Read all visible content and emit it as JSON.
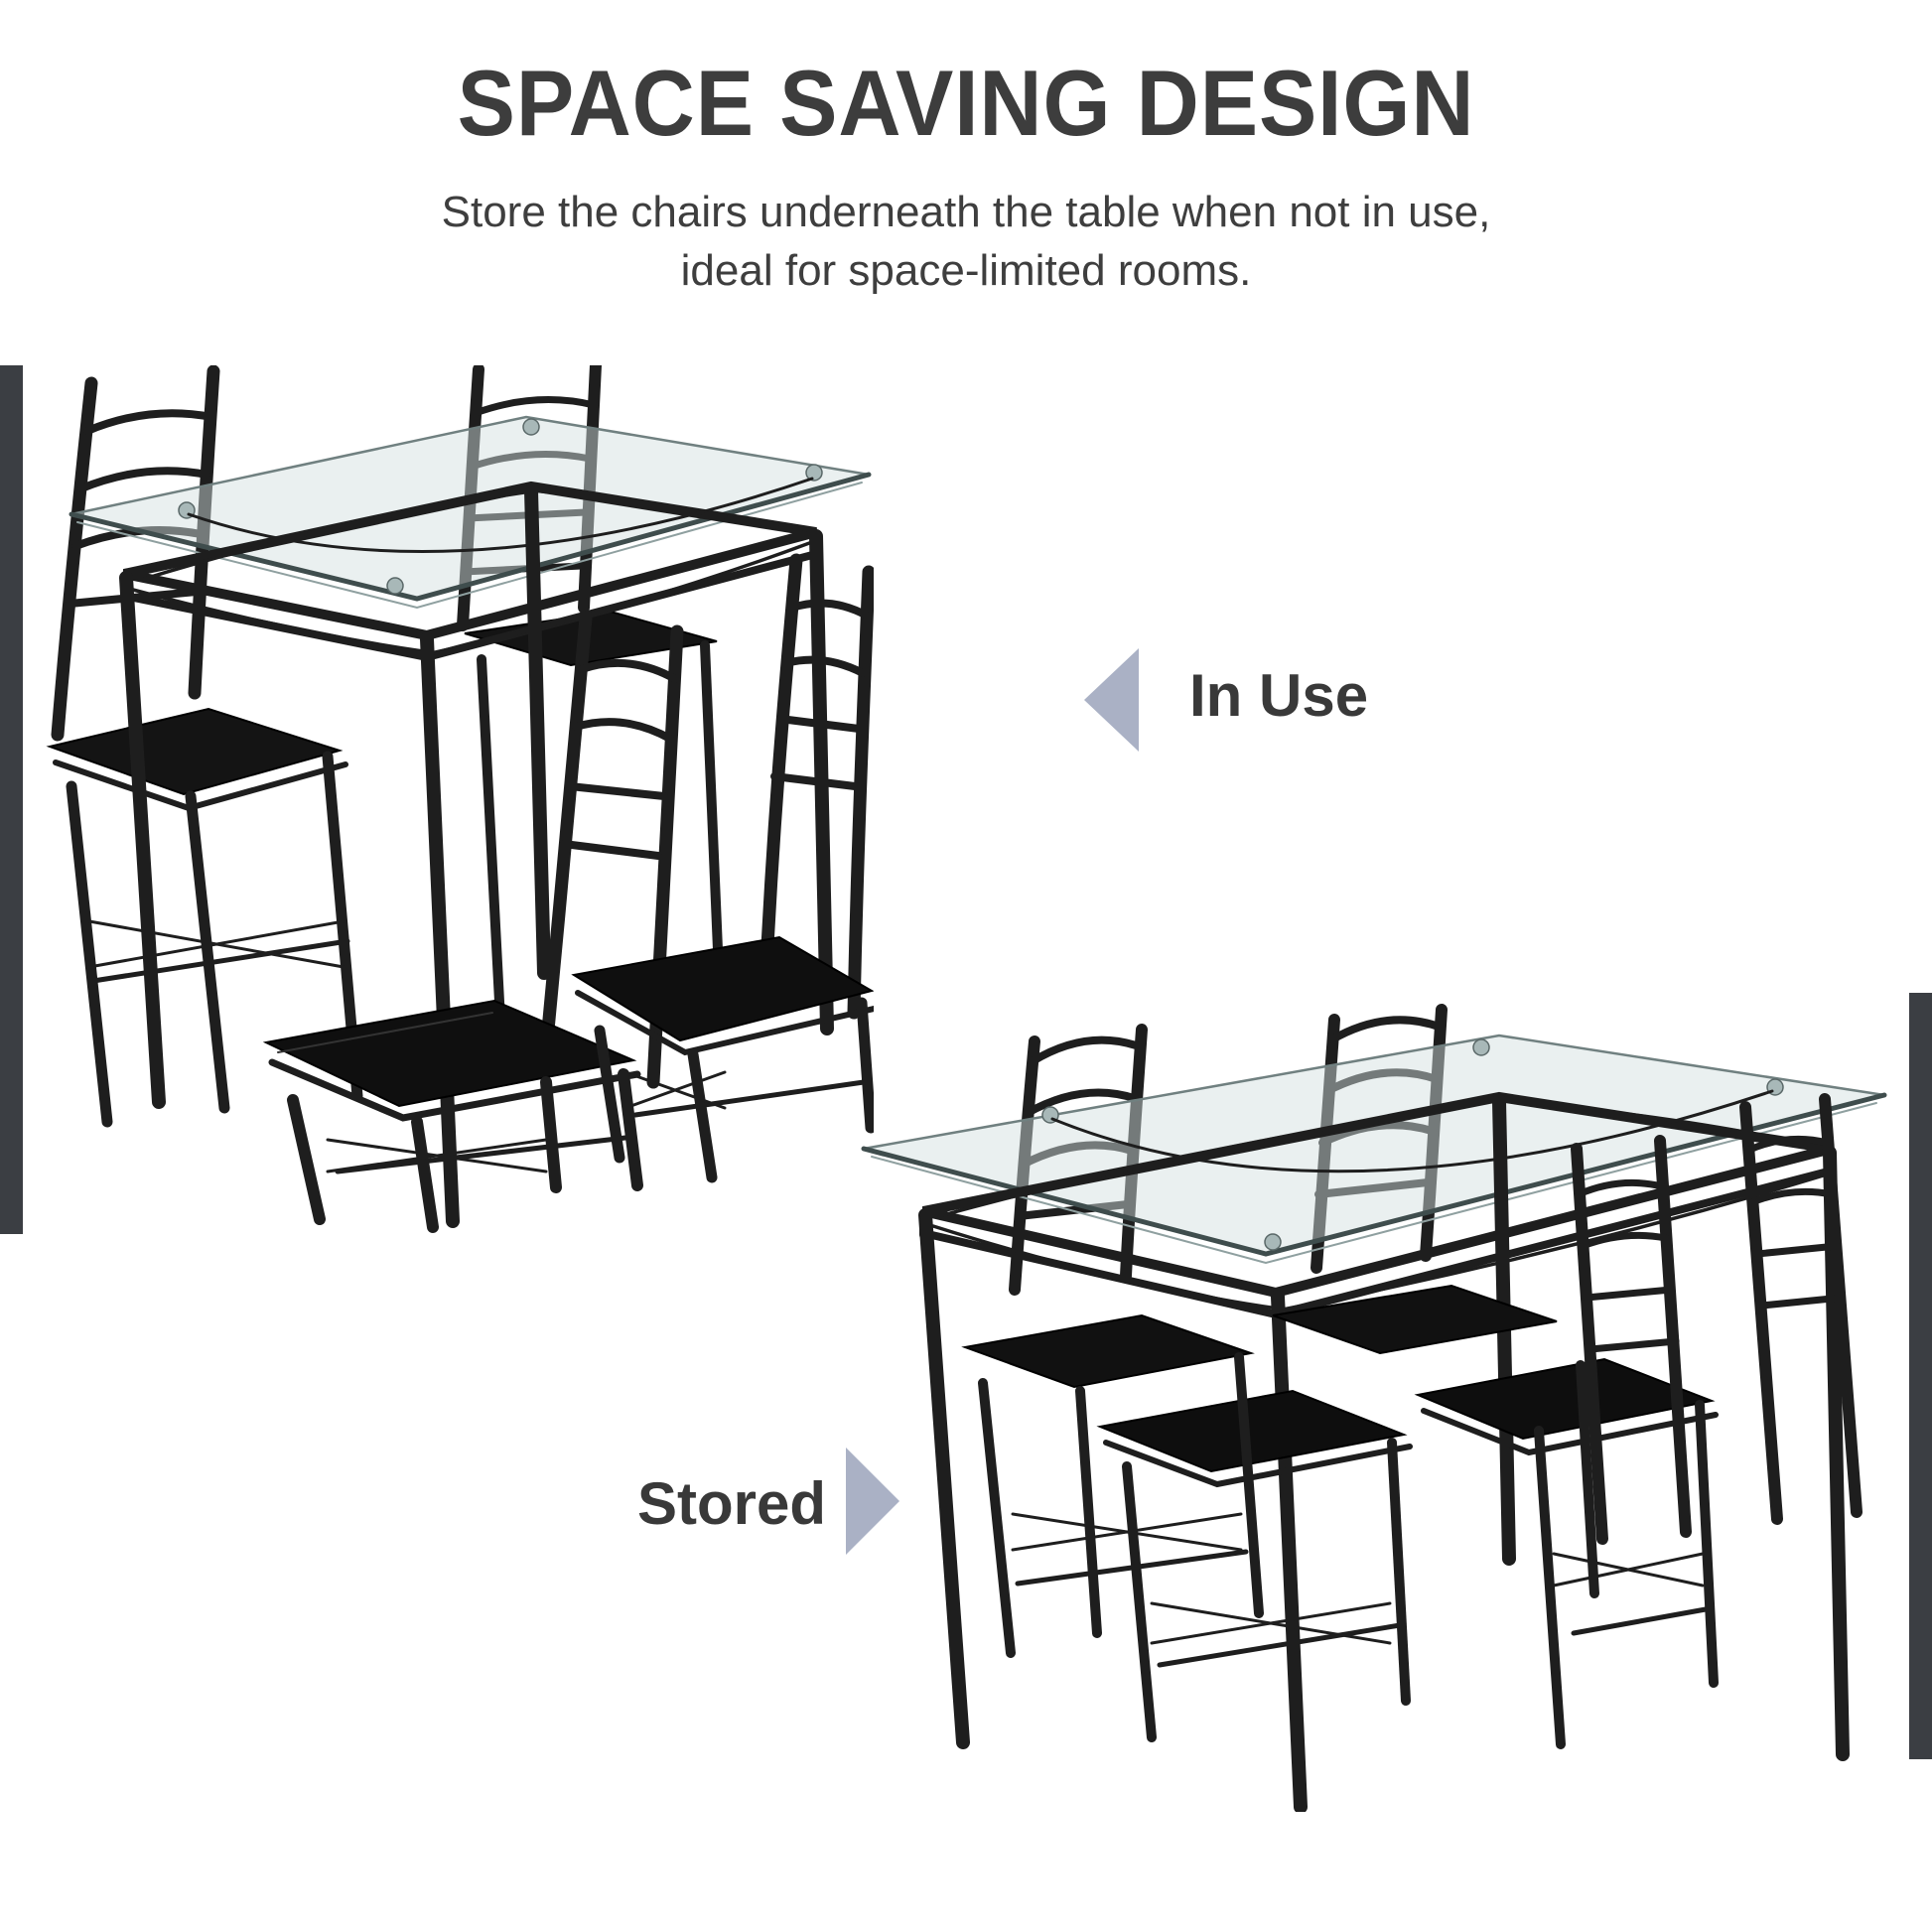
{
  "header": {
    "title": "SPACE SAVING DESIGN",
    "subtitle_line1": "Store the chairs underneath the table when not in use,",
    "subtitle_line2": "ideal for space-limited rooms."
  },
  "annotations": {
    "in_use": {
      "label": "In Use",
      "arrow_direction": "left"
    },
    "stored": {
      "label": "Stored",
      "arrow_direction": "right"
    }
  },
  "figures": {
    "in_use_photo_alt": "Glass-top dining table with black metal frame and four black ladder-back chairs placed around it",
    "stored_photo_alt": "Same dining set with all four chairs tucked underneath the glass-top table"
  },
  "colors": {
    "text": "#3d3d3d",
    "arrow": "#aab1c5",
    "edge_bar": "#3b3e43",
    "furniture_metal": "#1e1e1e",
    "seat_cushion": "#111111",
    "glass_tint": "#d4e0e0"
  }
}
